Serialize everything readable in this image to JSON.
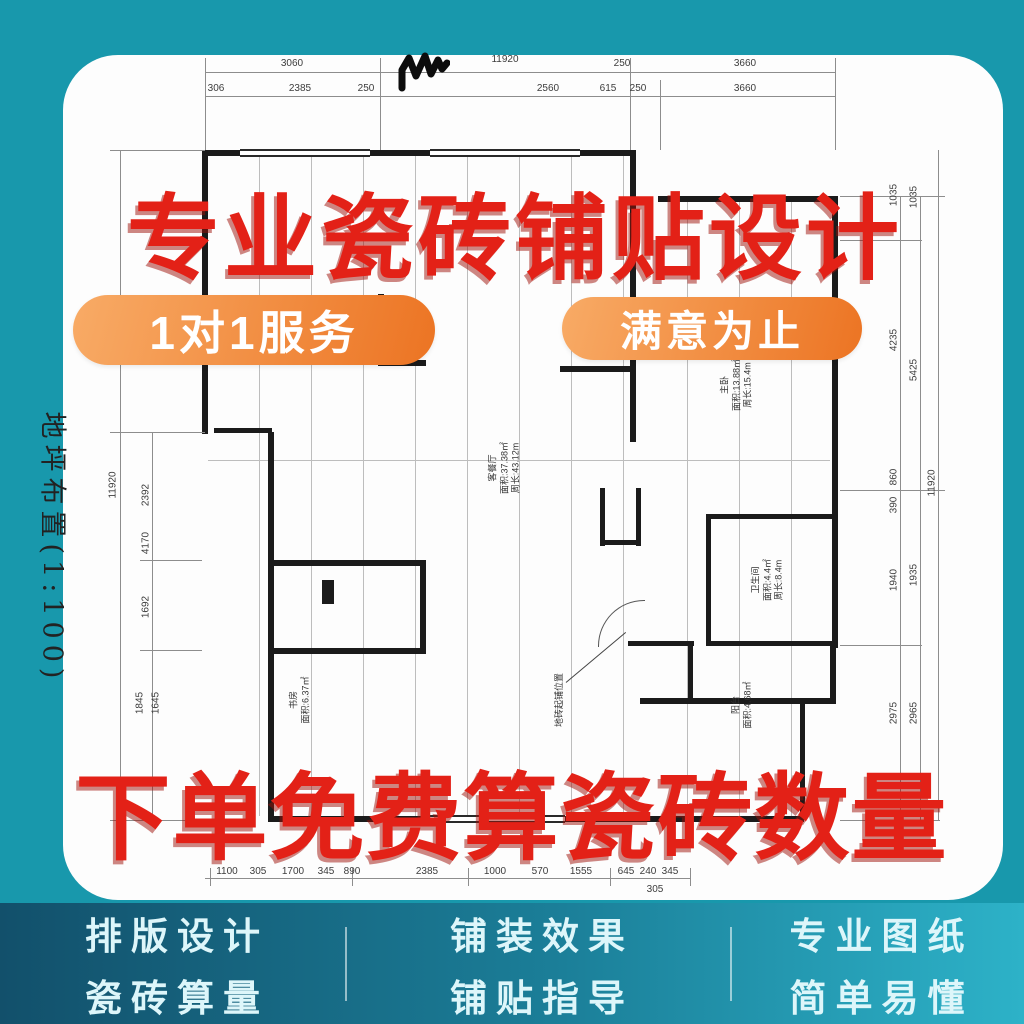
{
  "overlay": {
    "title_top": "专业瓷砖铺贴设计",
    "badge_left": "1对1服务",
    "badge_right": "满意为止",
    "title_bottom": "下单免费算瓷砖数量",
    "accent_red": "#e32117",
    "badge_orange": "#ed7a27"
  },
  "plan": {
    "scale_label": "地坪布置(1:100)",
    "dims": {
      "top_row1": [
        "3060",
        "11920",
        "250",
        "3660"
      ],
      "top_row2": [
        "306",
        "2385",
        "250",
        "2560",
        "615",
        "250",
        "3660"
      ],
      "bottom": [
        "1100",
        "305",
        "1700",
        "345",
        "890",
        "2385",
        "1000",
        "570",
        "1555",
        "645",
        "240",
        "345",
        "305"
      ],
      "left_outer": "11920",
      "left_inner": [
        "2392",
        "4170",
        "1692",
        "1845",
        "1645"
      ],
      "right_inner": [
        "1035",
        "4235",
        "860",
        "390",
        "1940",
        "2975"
      ],
      "right_outer": [
        "1035",
        "5425",
        "1935",
        "2965"
      ],
      "right_total": "11920"
    },
    "rooms": {
      "living": "客餐厅\n面积:37.38㎡\n周长:43.12m",
      "master": "主卧\n面积:13.88㎡\n周长:15.4m",
      "bath": "卫生间\n面积:4.4㎡\n周长:8.4m",
      "study": "书房\n面积:6.37㎡",
      "balcony": "阳台\n面积:4.68㎡",
      "note": "地砖起铺位置"
    }
  },
  "footer": {
    "columns": [
      {
        "line1": "排版设计",
        "line2": "瓷砖算量"
      },
      {
        "line1": "铺装效果",
        "line2": "铺贴指导"
      },
      {
        "line1": "专业图纸",
        "line2": "简单易懂"
      }
    ]
  }
}
